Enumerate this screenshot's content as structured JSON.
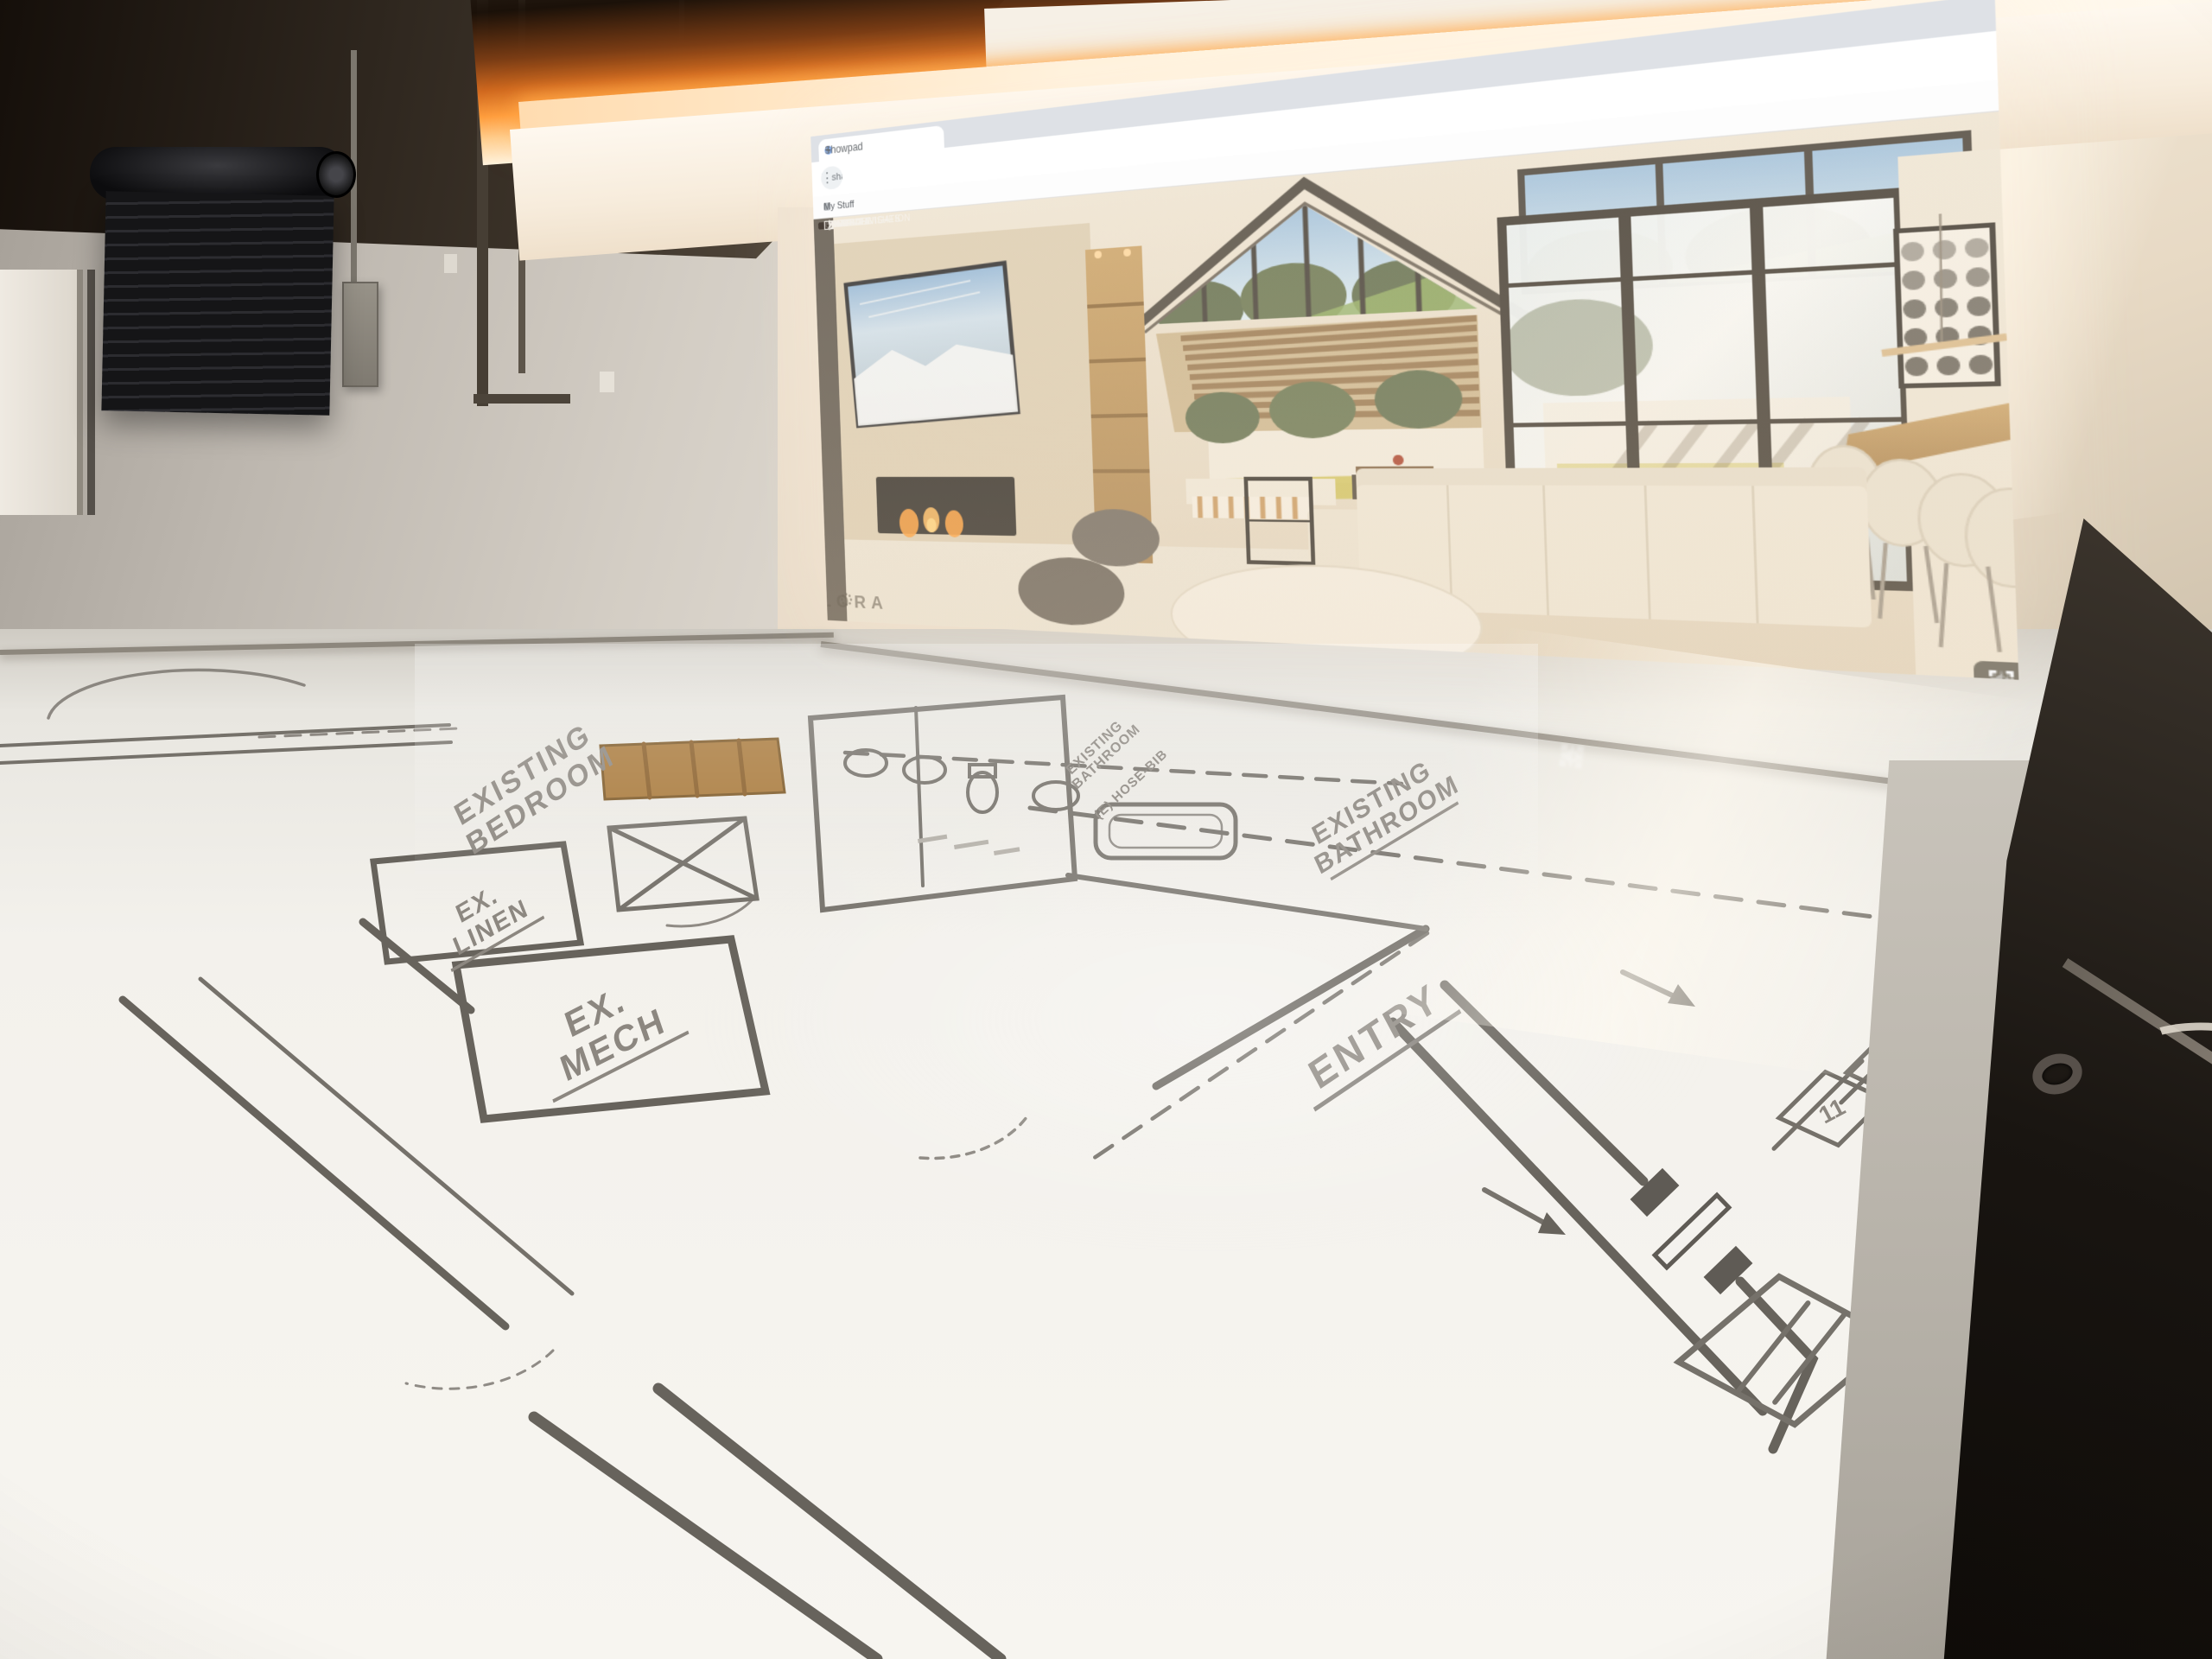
{
  "browser": {
    "tab_title": "Showpad",
    "tab_close": "×",
    "new_tab": "+",
    "url": "share.showpad.ai/470821S447BJLDN/a4",
    "bookmark_label": "My Stuff",
    "nav": {
      "back": "←",
      "forward": "→",
      "reload": "↻",
      "menu": "⋮"
    }
  },
  "app_toolbar": {
    "items": [
      {
        "label": "PROJECTS",
        "icon": "cube-icon"
      },
      {
        "label": "SUN",
        "icon": "sun-icon"
      },
      {
        "label": "PLAN & NAVIGATION",
        "icon": "lock-icon"
      },
      {
        "label": "DESIGN FINISHES",
        "icon": "ruler-icon"
      },
      {
        "label": "EDIT",
        "icon": "pencil-icon"
      },
      {
        "label": "COST",
        "icon": "dollar-icon"
      },
      {
        "label": "MEDIA",
        "icon": "image-icon"
      },
      {
        "label": "ABOUT",
        "icon": "question-icon"
      },
      {
        "label": "USER",
        "icon": "user-icon"
      },
      {
        "label": "CAMERA",
        "icon": "camera-icon"
      },
      {
        "label": "SETTINGS",
        "icon": "gear-icon"
      },
      {
        "label": "CONTROLS",
        "icon": "accessibility-icon"
      }
    ],
    "dollar_glyph": "$",
    "question_glyph": "?",
    "logout_icon": "logout-icon"
  },
  "viewer": {
    "watermark": "ELORA",
    "controls": [
      "settings-icon",
      "mute-icon",
      "fullscreen-icon"
    ]
  },
  "floor_plan": {
    "labels": {
      "bedroom_line1": "EXISTING",
      "bedroom_line2": "BEDROOM",
      "linen_line1": "EX.",
      "linen_line2": "LINEN",
      "mech_line1": "EX.",
      "mech_line2": "MECH",
      "entry": "ENTRY",
      "bathroom_line1": "EXISTING",
      "bathroom_line2": "BATHROOM",
      "bathroom_small_line1": "EXISTING",
      "bathroom_small_line2": "BATHROOM",
      "hose_bib": "(E) HOSE-BIB"
    },
    "keynotes": {
      "k1": "11",
      "k2": "12"
    }
  },
  "colors": {
    "cove_glow": "#ff9e3e",
    "chip_bg": "rgba(72,63,54,0.72)",
    "plan_line": "#75716a",
    "wall_beige": "#e8ddd0",
    "floor_white": "#f2f0ea"
  }
}
